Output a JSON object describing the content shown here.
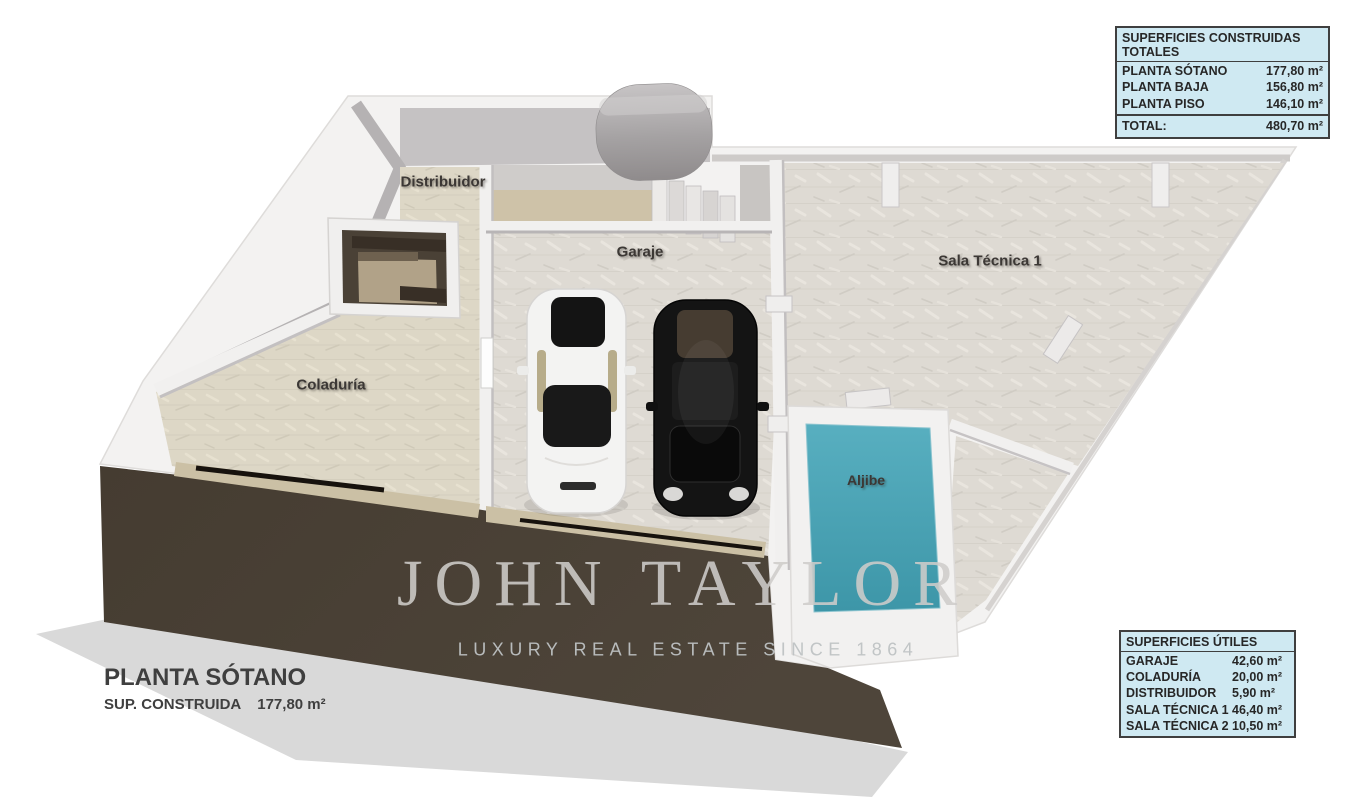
{
  "plan": {
    "title": "PLANTA SÓTANO",
    "area_label": "SUP. CONSTRUIDA",
    "area_value": "177,80 m²",
    "rooms": [
      {
        "label": "Distribuidor"
      },
      {
        "label": "Garaje"
      },
      {
        "label": "Sala Técnica 1"
      },
      {
        "label": "Coladuría"
      },
      {
        "label": "Aljibe"
      }
    ]
  },
  "watermark": {
    "brand": "JOHN TAYLOR",
    "tagline": "LUXURY REAL ESTATE SINCE 1864"
  },
  "tables": {
    "construidas": {
      "title": "SUPERFICIES CONSTRUIDAS TOTALES",
      "rows": [
        {
          "label": "PLANTA SÓTANO",
          "value": "177,80 m²"
        },
        {
          "label": "PLANTA BAJA",
          "value": "156,80 m²"
        },
        {
          "label": "PLANTA PISO",
          "value": "146,10 m²"
        }
      ],
      "total_label": "TOTAL:",
      "total_value": "480,70 m²"
    },
    "utiles": {
      "title": "SUPERFICIES ÚTILES",
      "rows": [
        {
          "label": "GARAJE",
          "value": "42,60 m²"
        },
        {
          "label": "COLADURÍA",
          "value": "20,00 m²"
        },
        {
          "label": "DISTRIBUIDOR",
          "value": "5,90 m²"
        },
        {
          "label": "SALA TÉCNICA 1",
          "value": "46,40 m²"
        },
        {
          "label": "SALA TÉCNICA 2",
          "value": "10,50 m²"
        }
      ]
    }
  },
  "colors": {
    "wall_white": "#f3f2f1",
    "floor_stone": "#dedad3",
    "floor_beige": "#ddd7c6",
    "aljibe_teal": "#4aa2b4",
    "ramp_brown": "#4a4137",
    "stair_brown": "#4a4136",
    "table_bg": "#cfe9f2",
    "table_border": "#3f3f3f",
    "text_dark": "#2b2b2b",
    "watermark_gray": "#c6c4c1"
  }
}
